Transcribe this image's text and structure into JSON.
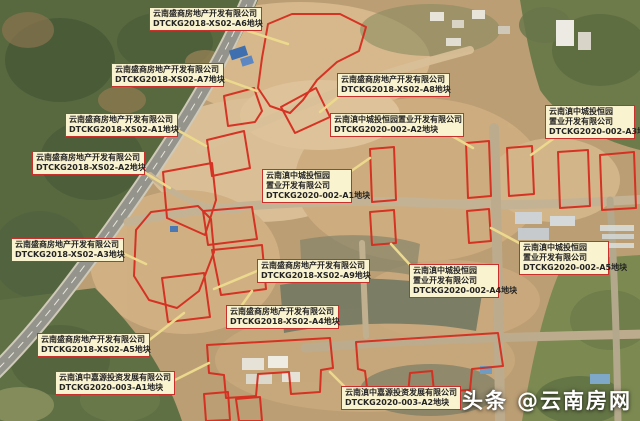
{
  "watermark": {
    "brand": "头条",
    "handle": "@云南房网"
  },
  "colors": {
    "parcel_outline": "#d62c1e",
    "label_bg": "#faf3d0",
    "label_border": "#c9302c",
    "label_text": "#242424",
    "leader_line": "#ecd98d",
    "watermark_text": "#ffffff"
  },
  "labels": [
    {
      "id": "XS02-A6",
      "lines": [
        "云南盛商房地产开发有限公司",
        "DTCKG2018-XS02-A6地块"
      ]
    },
    {
      "id": "XS02-A7",
      "lines": [
        "云南盛商房地产开发有限公司",
        "DTCKG2018-XS02-A7地块"
      ]
    },
    {
      "id": "XS02-A8",
      "lines": [
        "云南盛商房地产开发有限公司",
        "DTCKG2018-XS02-A8地块"
      ]
    },
    {
      "id": "XS02-A1",
      "lines": [
        "云南盛商房地产开发有限公司",
        "DTCKG2018-XS02-A1地块"
      ]
    },
    {
      "id": "002-A2",
      "lines": [
        "云南滇中城投恒园置业开发有限公司",
        "DTCKG2020-002-A2地块"
      ]
    },
    {
      "id": "002-A3",
      "lines": [
        "云南滇中城投恒园",
        "置业开发有限公司",
        "DTCKG2020-002-A3地块"
      ]
    },
    {
      "id": "XS02-A2",
      "lines": [
        "云南盛商房地产开发有限公司",
        "DTCKG2018-XS02-A2地块"
      ]
    },
    {
      "id": "002-A1",
      "lines": [
        "云南滇中城投恒园",
        "置业开发有限公司",
        "DTCKG2020-002-A1地块"
      ]
    },
    {
      "id": "XS02-A3",
      "lines": [
        "云南盛商房地产开发有限公司",
        "DTCKG2018-XS02-A3地块"
      ]
    },
    {
      "id": "XS02-A9",
      "lines": [
        "云南盛商房地产开发有限公司",
        "DTCKG2018-XS02-A9地块"
      ]
    },
    {
      "id": "002-A4",
      "lines": [
        "云南滇中城投恒园",
        "置业开发有限公司",
        "DTCKG2020-002-A4地块"
      ]
    },
    {
      "id": "002-A5",
      "lines": [
        "云南滇中城投恒园",
        "置业开发有限公司",
        "DTCKG2020-002-A5地块"
      ]
    },
    {
      "id": "XS02-A4",
      "lines": [
        "云南盛商房地产开发有限公司",
        "DTCKG2018-XS02-A4地块"
      ]
    },
    {
      "id": "XS02-A5",
      "lines": [
        "云南盛商房地产开发有限公司",
        "DTCKG2018-XS02-A5地块"
      ]
    },
    {
      "id": "003-A1",
      "lines": [
        "云南滇中嘉源投资发展有限公司",
        "DTCKG2020-003-A1地块"
      ]
    },
    {
      "id": "003-A2",
      "lines": [
        "云南滇中嘉源投资发展有限公司",
        "DTCKG2020-003-A2地块"
      ]
    }
  ]
}
